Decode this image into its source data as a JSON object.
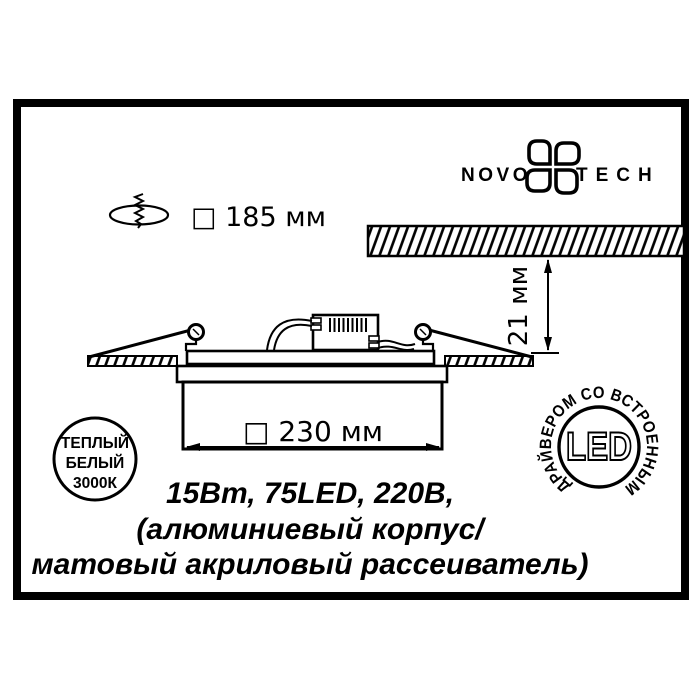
{
  "colors": {
    "ink": "#000000",
    "paper": "#ffffff"
  },
  "logo": {
    "word_left": "NOVO",
    "word_right": "TECH"
  },
  "cutout_dim": {
    "label": "□ 185 мм"
  },
  "recess": {
    "depth_label": "21 мм"
  },
  "fixture": {
    "width_label": "□ 230 мм"
  },
  "specs": {
    "line1": "15Вт, 75LED, 220В,",
    "line2": "(алюминиевый корпус/",
    "line3": "матовый акриловый рассеиватель)"
  },
  "warm_white_badge": {
    "line1": "ТЕПЛЫЙ",
    "line2": "БЕЛЫЙ",
    "line3": "3000К"
  },
  "led_badge": {
    "center_label": "LED",
    "ring_label": "ДРАЙВЕРОМ СО ВСТРОЕННЫМ"
  }
}
